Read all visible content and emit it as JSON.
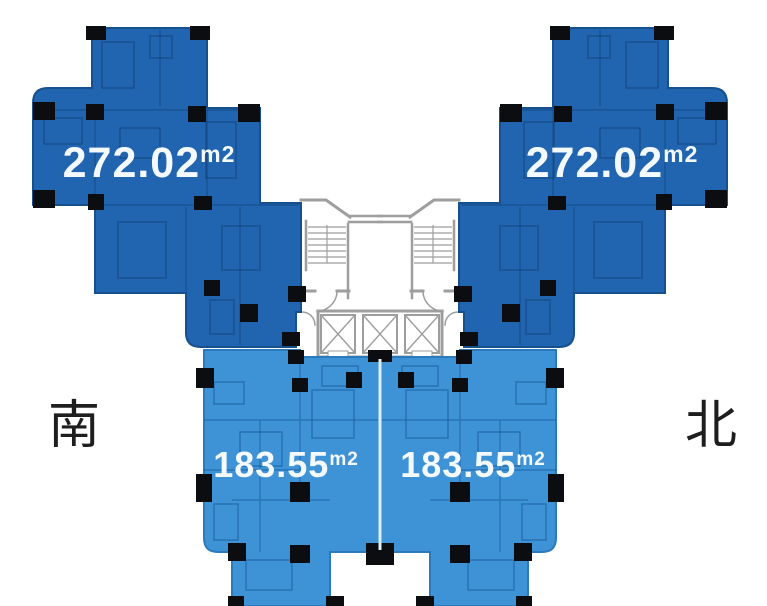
{
  "plan": {
    "compass": {
      "south_label": "南",
      "north_label": "北"
    },
    "units": [
      {
        "id": "upper-left",
        "area": "272.02",
        "area_unit": "m2"
      },
      {
        "id": "upper-right",
        "area": "272.02",
        "area_unit": "m2"
      },
      {
        "id": "lower-left",
        "area": "183.55",
        "area_unit": "m2"
      },
      {
        "id": "lower-right",
        "area": "183.55",
        "area_unit": "m2"
      }
    ],
    "colors": {
      "background": "#ffffff",
      "unit_large": "#2165b0",
      "unit_small": "#3e92d6",
      "column": "#0c0d10",
      "wall": "#9e9e9e",
      "area_text": "#f4f9fd",
      "compass_text": "#1e1e1e",
      "divider": "#dceefb"
    }
  }
}
